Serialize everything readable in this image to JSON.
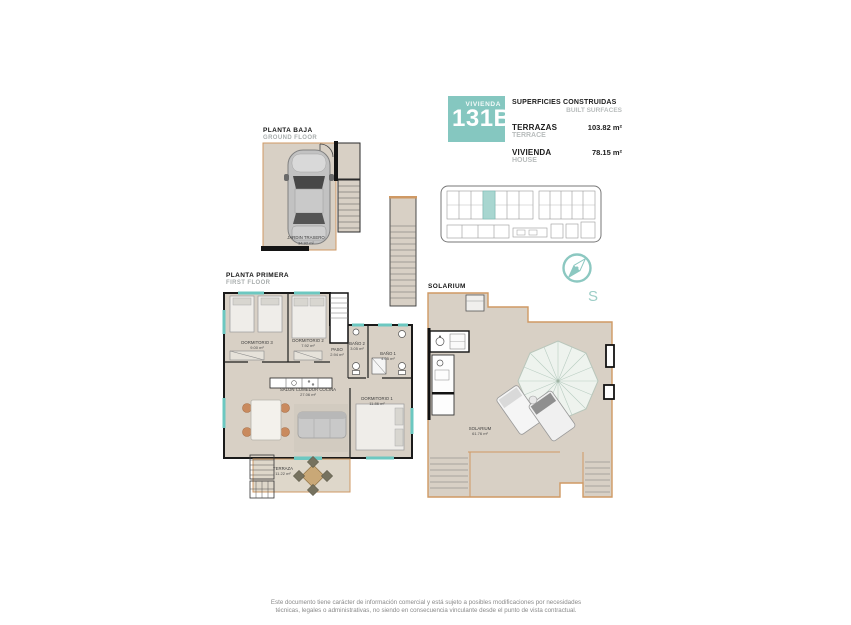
{
  "colors": {
    "accent": "#85c7c0",
    "floor_fill": "#d8d0c5",
    "terrace_line": "#cf9964"
  },
  "title_block": {
    "vivienda_label": "VIVIENDA",
    "unit_number": "131B",
    "surfaces_title": "SUPERFICIES CONSTRUIDAS",
    "surfaces_title_en": "BUILT SURFACES",
    "rows": [
      {
        "label": "TERRAZAS",
        "label_en": "TERRACE",
        "value": "103.82 m²"
      },
      {
        "label": "VIVIENDA",
        "label_en": "HOUSE",
        "value": "78.15 m²"
      }
    ]
  },
  "floors": {
    "ground": {
      "label": "PLANTA BAJA",
      "label_en": "GROUND FLOOR",
      "rooms": [
        {
          "name": "JARDIN TRASERO",
          "area": "34.92 m²"
        }
      ]
    },
    "first": {
      "label": "PLANTA PRIMERA",
      "label_en": "FIRST FLOOR",
      "rooms": [
        {
          "name": "DORMITORIO 3",
          "area": "9.00 m²"
        },
        {
          "name": "DORMITORIO 2",
          "area": "7.92 m²"
        },
        {
          "name": "PASO",
          "area": "2.94 m²"
        },
        {
          "name": "BAÑO 2",
          "area": "3.05 m²"
        },
        {
          "name": "BAÑO 1",
          "area": "4.05 m²"
        },
        {
          "name": "SALON COMEDOR COCINA",
          "area": "27.06 m²"
        },
        {
          "name": "DORMITORIO 1",
          "area": "11.86 m²"
        },
        {
          "name": "TERRAZA",
          "area": "11.22 m²"
        }
      ]
    },
    "solarium": {
      "label": "SOLARIUM",
      "rooms": [
        {
          "name": "SOLARIUM",
          "area": "61.76 m²"
        }
      ]
    }
  },
  "compass": {
    "letter": "S"
  },
  "footer": {
    "disclaimer": "Este documento tiene carácter de información comercial y está sujeto a posibles modificaciones por necesidades técnicas, legales o administrativas, no siendo en consecuencia vinculante desde el punto de vista contractual."
  }
}
